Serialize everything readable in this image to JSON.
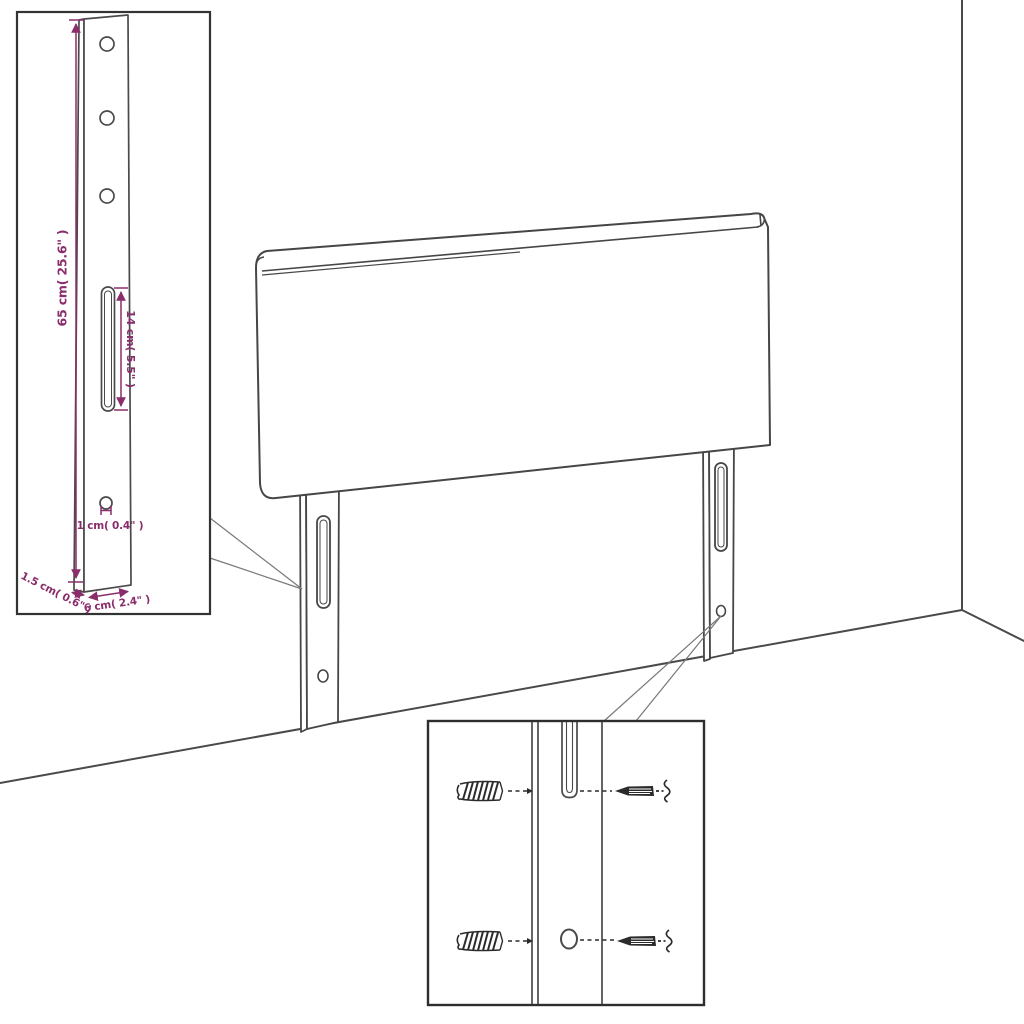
{
  "diagram": {
    "background": "#ffffff",
    "outline_color": "#464646",
    "callout_color": "#787878",
    "dimension_color": "#8a2d6b",
    "scene_parts": [
      "headboard-panel",
      "left-leg-bracket",
      "right-leg-bracket",
      "wall-corner",
      "floor"
    ],
    "insets": {
      "bracket": {
        "labels": {
          "height": "65 cm( 25.6\" )",
          "slot_length": "14 cm( 5.5\" )",
          "hole": "1 cm( 0.4\" )",
          "thickness": "1.5 cm( 0.6\" )",
          "width": "6 cm( 2.4\" )"
        }
      },
      "mounting": {
        "parts": [
          "wall-plug",
          "screw"
        ]
      }
    }
  }
}
